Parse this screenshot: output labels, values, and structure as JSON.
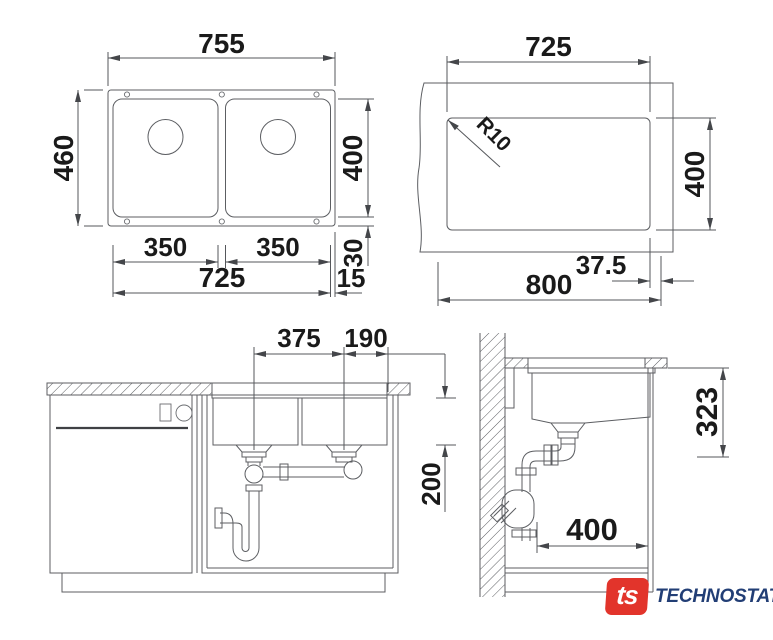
{
  "title": "sink-technical-drawing",
  "colors": {
    "background": "#ffffff",
    "line": "#5c5e62",
    "text": "#1a1a1a",
    "logo_red": "#e2342b",
    "logo_navy": "#223e75"
  },
  "views": {
    "top": {
      "label": "sink-top-view",
      "dim_overall_width": "755",
      "dim_overall_depth": "460",
      "dim_bowl_depth": "400",
      "dim_bowl_left_width": "350",
      "dim_bowl_right_width": "350",
      "dim_bowls_span": "725",
      "dim_rear_margin": "30",
      "dim_side_margin": "15"
    },
    "cutout": {
      "label": "countertop-cutout-template",
      "dim_cutout_width": "725",
      "dim_corner_radius": "R10",
      "dim_cutout_depth": "400",
      "dim_edge_offset": "37.5",
      "dim_cabinet_width": "800"
    },
    "front": {
      "label": "front-installation-view",
      "dim_drain_spacing": "375",
      "dim_drain_to_edge": "190",
      "dim_depth_below_top": "200"
    },
    "side": {
      "label": "side-installation-view",
      "dim_mounting_depth": "323",
      "dim_trap_to_front": "400"
    }
  },
  "logo": {
    "mark": "ts",
    "brand": "TECHNOSTATUS"
  }
}
